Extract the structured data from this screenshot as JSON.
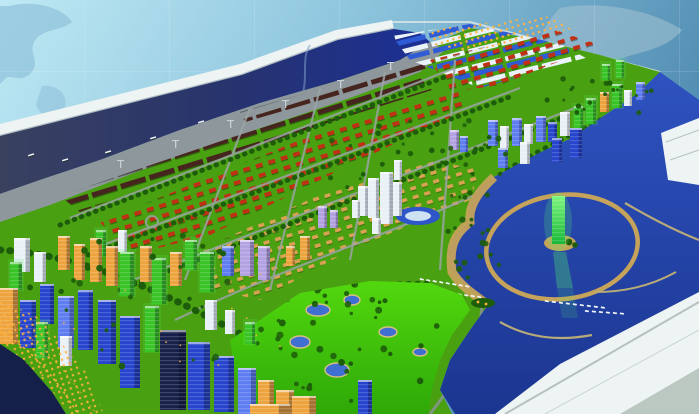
{
  "meta": {
    "type": "photograph",
    "subject": "architectural scale model of a coastal city master plan displayed on a white table",
    "backdrop": "light blue wall with faint world map and grid lines"
  },
  "palette": {
    "wall_light": "#bfe9f4",
    "wall_dark": "#4e8ab0",
    "wall_map_left": "#8fc2da",
    "wall_map_right": "#a4c2d2",
    "rim_white": "#eef3f4",
    "rim_shade": "#93a4ac",
    "river_dark": "#39415f",
    "river_blue": "#1b2f96",
    "bay_top": "#2e52c0",
    "bay_bottom": "#1b3690",
    "pond_blue": "#3f6fd0",
    "pond_sand": "#d8c080",
    "apron_gray": "#8e979b",
    "warehouse_dark": "#46251e",
    "shed_blue": "#2f5bd4",
    "shed_white": "#eaf2fa",
    "field_green": "#49a011",
    "golf_light": "#52d80e",
    "golf_dark": "#2ea808",
    "park_dark": "#1d5c0a",
    "roof_red": "#c03014",
    "house_tan": "#d8a252",
    "sand_tan": "#c6a35a",
    "jetty_tan": "#b8ab79",
    "road_gray": "#9aa4a4",
    "tower_blue": "#2644cc",
    "tower_blue_lt": "#5e7df0",
    "tower_green": "#38c426",
    "tower_white": "#e9f1f6",
    "tower_orange": "#eda33e",
    "tower_lavender": "#b3a2e2",
    "tower_navy": "#17204a",
    "marina_tower_top": "#7df57e",
    "marina_tower_bottom": "#18b838",
    "marina_glow": "#51f06a",
    "light_orange": "#ffb23e",
    "dark_water": "#14204a",
    "stadium_ring": "#2e56c8",
    "stadium_core": "#cfe2f4",
    "corner_seam": "#b6c0bf",
    "corner_shade": "#aebbb4",
    "boat_white": "#f2f6f8"
  },
  "regions": [
    {
      "name": "backdrop-wall",
      "desc": "light blue wall with world map silhouettes and grid"
    },
    {
      "name": "table-rim",
      "desc": "white beveled edge of the model table"
    },
    {
      "name": "shipping-channel",
      "desc": "dark blue harbor channel with ships"
    },
    {
      "name": "port-wharf",
      "desc": "gray wharf apron with dark warehouse rows and cranes"
    },
    {
      "name": "logistics-sheds",
      "desc": "blue and white striped warehouse rows"
    },
    {
      "name": "residential-grid",
      "desc": "green blocks with rows of red and tan roofed houses"
    },
    {
      "name": "central-towers",
      "desc": "white high-rise cluster at city center"
    },
    {
      "name": "stadium",
      "desc": "blue oval arena"
    },
    {
      "name": "eastern-towers",
      "desc": "blue, green and white tower clusters near the bay"
    },
    {
      "name": "marina-lagoon",
      "desc": "circular lagoon with sand breakwater ring"
    },
    {
      "name": "lighthouse-tower",
      "desc": "glowing green tower on a small island"
    },
    {
      "name": "golf-course",
      "desc": "bright green course with ponds and trees"
    },
    {
      "name": "downtown-towers",
      "desc": "dense illuminated skyscraper district"
    },
    {
      "name": "waterfront-promenade",
      "desc": "lit shoreline promenade at lower left"
    },
    {
      "name": "bay-water",
      "desc": "deep blue bay with curved jetties and boats"
    },
    {
      "name": "table-corner",
      "desc": "white table corner at lower right"
    }
  ],
  "scene": {
    "towers": [
      [
        14,
        238,
        16,
        34,
        "tower_white"
      ],
      [
        34,
        252,
        12,
        30,
        "tower_white"
      ],
      [
        58,
        236,
        12,
        34,
        "tower_orange"
      ],
      [
        74,
        244,
        11,
        36,
        "tower_orange"
      ],
      [
        90,
        238,
        12,
        44,
        "tower_orange"
      ],
      [
        106,
        246,
        12,
        40,
        "tower_orange"
      ],
      [
        96,
        230,
        10,
        26,
        "tower_green"
      ],
      [
        120,
        252,
        14,
        44,
        "tower_green"
      ],
      [
        140,
        246,
        12,
        36,
        "tower_orange"
      ],
      [
        152,
        258,
        14,
        46,
        "tower_green"
      ],
      [
        170,
        252,
        12,
        34,
        "tower_orange"
      ],
      [
        118,
        230,
        9,
        22,
        "tower_white"
      ],
      [
        185,
        240,
        12,
        30,
        "tower_green"
      ],
      [
        200,
        252,
        14,
        40,
        "tower_green"
      ],
      [
        222,
        246,
        12,
        30,
        "tower_blue_lt"
      ],
      [
        240,
        240,
        14,
        36,
        "tower_lavender"
      ],
      [
        258,
        246,
        12,
        34,
        "tower_lavender"
      ],
      [
        318,
        206,
        9,
        22,
        "tower_lavender"
      ],
      [
        330,
        210,
        8,
        18,
        "tower_lavender"
      ],
      [
        0,
        288,
        18,
        56,
        "tower_orange"
      ],
      [
        20,
        300,
        16,
        48,
        "tower_blue"
      ],
      [
        40,
        284,
        14,
        40,
        "tower_blue"
      ],
      [
        58,
        296,
        16,
        52,
        "tower_blue_lt"
      ],
      [
        78,
        290,
        15,
        60,
        "tower_blue"
      ],
      [
        98,
        300,
        18,
        64,
        "tower_blue"
      ],
      [
        120,
        316,
        20,
        72,
        "tower_blue"
      ],
      [
        145,
        306,
        14,
        46,
        "tower_green"
      ],
      [
        160,
        330,
        26,
        80,
        "tower_navy"
      ],
      [
        188,
        342,
        22,
        68,
        "tower_blue"
      ],
      [
        214,
        356,
        20,
        56,
        "tower_blue"
      ],
      [
        238,
        368,
        18,
        46,
        "tower_blue_lt"
      ],
      [
        258,
        380,
        16,
        34,
        "tower_orange"
      ],
      [
        276,
        390,
        18,
        24,
        "tower_orange"
      ],
      [
        36,
        322,
        12,
        36,
        "tower_green"
      ],
      [
        60,
        336,
        12,
        30,
        "tower_white"
      ],
      [
        205,
        300,
        12,
        30,
        "tower_white"
      ],
      [
        225,
        310,
        10,
        24,
        "tower_white"
      ],
      [
        245,
        322,
        10,
        22,
        "tower_green"
      ],
      [
        10,
        262,
        12,
        28,
        "tower_green"
      ],
      [
        250,
        404,
        40,
        10,
        "tower_orange"
      ],
      [
        292,
        396,
        24,
        18,
        "tower_orange"
      ],
      [
        358,
        380,
        14,
        34,
        "tower_blue"
      ],
      [
        488,
        120,
        10,
        26,
        "tower_blue_lt"
      ],
      [
        500,
        126,
        9,
        22,
        "tower_white"
      ],
      [
        512,
        118,
        10,
        28,
        "tower_blue_lt"
      ],
      [
        524,
        124,
        9,
        20,
        "tower_white"
      ],
      [
        536,
        116,
        10,
        26,
        "tower_blue_lt"
      ],
      [
        548,
        122,
        9,
        20,
        "tower_blue"
      ],
      [
        560,
        112,
        10,
        24,
        "tower_white"
      ],
      [
        574,
        106,
        9,
        22,
        "tower_green"
      ],
      [
        586,
        98,
        10,
        26,
        "tower_green"
      ],
      [
        600,
        92,
        9,
        20,
        "tower_orange"
      ],
      [
        612,
        84,
        10,
        24,
        "tower_green"
      ],
      [
        624,
        90,
        8,
        16,
        "tower_white"
      ],
      [
        636,
        82,
        9,
        18,
        "tower_blue_lt"
      ],
      [
        602,
        64,
        8,
        16,
        "tower_green"
      ],
      [
        616,
        60,
        8,
        18,
        "tower_green"
      ],
      [
        570,
        128,
        12,
        30,
        "tower_blue"
      ],
      [
        552,
        138,
        10,
        24,
        "tower_blue"
      ],
      [
        520,
        142,
        10,
        22,
        "tower_white"
      ],
      [
        498,
        148,
        10,
        20,
        "tower_blue_lt"
      ],
      [
        358,
        186,
        10,
        30,
        "tower_white"
      ],
      [
        368,
        178,
        11,
        40,
        "tower_white"
      ],
      [
        380,
        172,
        13,
        52,
        "tower_white"
      ],
      [
        372,
        218,
        9,
        16,
        "tower_white"
      ],
      [
        392,
        182,
        10,
        34,
        "tower_white"
      ],
      [
        394,
        160,
        8,
        20,
        "tower_white"
      ],
      [
        352,
        200,
        8,
        18,
        "tower_white"
      ],
      [
        300,
        236,
        10,
        24,
        "tower_orange"
      ],
      [
        286,
        246,
        9,
        20,
        "tower_orange"
      ],
      [
        450,
        130,
        9,
        20,
        "tower_lavender"
      ],
      [
        460,
        136,
        8,
        16,
        "tower_blue_lt"
      ]
    ],
    "ships": [
      [
        28,
        155
      ],
      [
        62,
        160
      ],
      [
        105,
        152
      ],
      [
        150,
        138
      ],
      [
        198,
        122
      ],
      [
        240,
        130
      ]
    ],
    "cranes": [
      [
        120,
        168
      ],
      [
        175,
        148
      ],
      [
        230,
        128
      ],
      [
        285,
        108
      ],
      [
        340,
        88
      ],
      [
        390,
        70
      ]
    ],
    "ponds": [
      [
        318,
        310,
        12,
        6
      ],
      [
        352,
        300,
        8,
        5
      ],
      [
        300,
        342,
        10,
        6
      ],
      [
        388,
        332,
        9,
        5
      ],
      [
        337,
        370,
        12,
        7
      ],
      [
        420,
        352,
        7,
        4
      ]
    ],
    "boat_rows": [
      {
        "x": 420,
        "y": 278,
        "n": 8,
        "dx": 6.5,
        "dy": 1.0,
        "rot": 14
      },
      {
        "x": 432,
        "y": 290,
        "n": 8,
        "dx": 6.5,
        "dy": 0.8,
        "rot": 14
      },
      {
        "x": 545,
        "y": 300,
        "n": 9,
        "dx": 7.0,
        "dy": 0.8,
        "rot": 10
      },
      {
        "x": 585,
        "y": 310,
        "n": 6,
        "dx": 7.0,
        "dy": 0.5,
        "rot": 8
      }
    ],
    "tree_clusters": [
      {
        "n": 42,
        "cx": 345,
        "cy": 345,
        "rx": 100,
        "ry": 62,
        "rmin": 1.6,
        "rmax": 3.6,
        "clip": "clipGolf"
      },
      {
        "n": 34,
        "cx": 420,
        "cy": 160,
        "rx": 120,
        "ry": 48,
        "rmin": 1.4,
        "rmax": 3.0
      },
      {
        "n": 16,
        "cx": 468,
        "cy": 248,
        "rx": 38,
        "ry": 30,
        "rmin": 1.6,
        "rmax": 3.2
      },
      {
        "n": 20,
        "cx": 600,
        "cy": 96,
        "rx": 58,
        "ry": 24,
        "rmin": 1.4,
        "rmax": 2.8
      },
      {
        "n": 26,
        "cx": 150,
        "cy": 300,
        "rx": 130,
        "ry": 70,
        "rmin": 1.6,
        "rmax": 3.4
      }
    ],
    "street_lights": {
      "n": 16,
      "x": 0,
      "y": 260,
      "w": 290,
      "h": 140
    }
  }
}
